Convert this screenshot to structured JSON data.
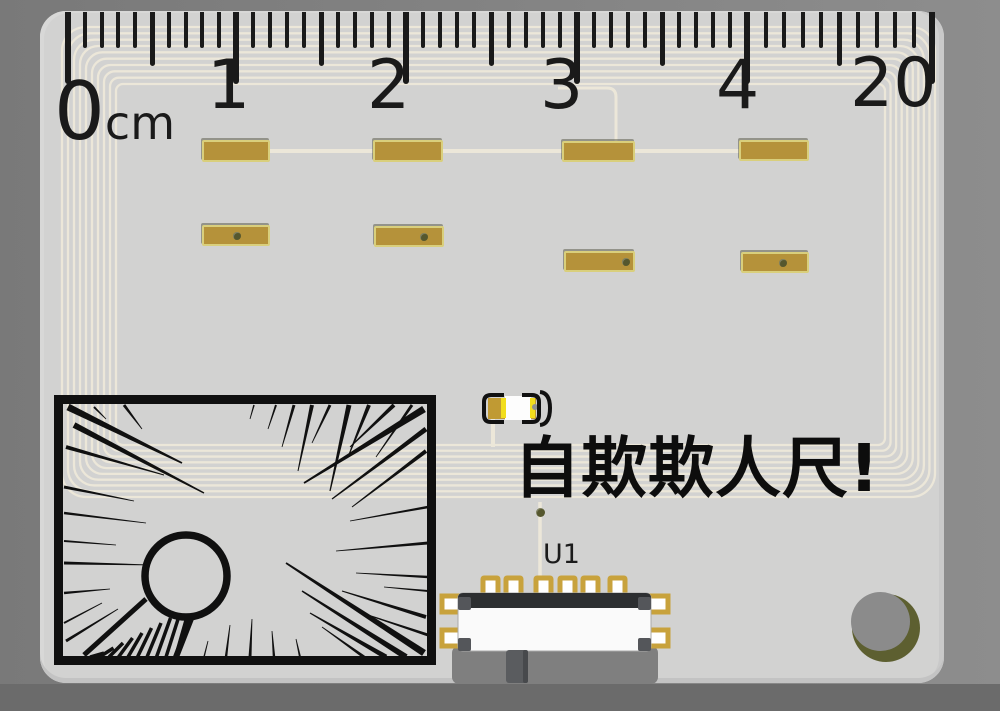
{
  "scene": {
    "description": "3D render of a novelty PCB ruler on gray backdrop",
    "caption": {
      "text": "自欺欺人尺!",
      "x": 514,
      "y": 436,
      "size": 66
    },
    "components": {
      "led": {
        "name": "led-d1",
        "x": 478,
        "y": 388
      },
      "switch": {
        "ref": "U1",
        "label_x": 543,
        "label_y": 541,
        "label_size": 27,
        "pin_count": 6
      },
      "mounting_hole": {
        "x": 845,
        "y": 586
      },
      "comic_panel": {
        "style": "manga speed lines with circle",
        "x": 54,
        "y": 395
      }
    }
  },
  "ruler": {
    "unit": "cm",
    "unit_size": 46,
    "numbers": [
      {
        "label": "0",
        "tick_x": 68,
        "label_x": 54,
        "label_y": 72,
        "size": 80
      },
      {
        "label": "1",
        "tick_x": 236,
        "label_x": 207,
        "label_y": 52,
        "size": 68
      },
      {
        "label": "2",
        "tick_x": 406,
        "label_x": 367,
        "label_y": 52,
        "size": 68
      },
      {
        "label": "3",
        "tick_x": 577,
        "label_x": 540,
        "label_y": 52,
        "size": 68
      },
      {
        "label": "4",
        "tick_x": 747,
        "label_x": 716,
        "label_y": 52,
        "size": 68
      },
      {
        "label": "20",
        "tick_x": 932,
        "label_x": 850,
        "label_y": 50,
        "size": 68
      }
    ],
    "minor_per_interval": 10,
    "tick_heights": {
      "minor": 36,
      "half": 54,
      "major": 72
    }
  },
  "pads": {
    "row1": [
      {
        "x": 202,
        "y": 140,
        "w": 68,
        "h": 22
      },
      {
        "x": 373,
        "y": 140,
        "w": 70,
        "h": 22
      },
      {
        "x": 562,
        "y": 141,
        "w": 73,
        "h": 21
      },
      {
        "x": 739,
        "y": 140,
        "w": 70,
        "h": 21
      }
    ],
    "row2": [
      {
        "x": 202,
        "y": 225,
        "w": 68,
        "h": 21,
        "via": 0.48
      },
      {
        "x": 374,
        "y": 226,
        "w": 70,
        "h": 21,
        "via": 0.68
      },
      {
        "x": 564,
        "y": 251,
        "w": 71,
        "h": 21,
        "via": 0.84
      },
      {
        "x": 741,
        "y": 252,
        "w": 68,
        "h": 21,
        "via": 0.59
      }
    ]
  },
  "antenna": {
    "loops": 10,
    "outer": [
      62,
      27,
      935,
      497
    ],
    "inner": [
      116,
      84,
      885,
      445
    ]
  },
  "colors": {
    "backdrop_left": "#797979",
    "backdrop_right": "#8d8d8d",
    "floor_shadow": "#6b6b6b",
    "board": "#d2d2d1",
    "trace_cream": "#ece7d9",
    "pad_gold": "#b5923a",
    "pad_border": "#d9cf7c",
    "ink_black": "#1a1a1a",
    "via_olive": "#55572e",
    "hole_olive": "#5d5f30",
    "led_yellow": "#f2dd1c",
    "switch_dark": "#2d2f31"
  }
}
